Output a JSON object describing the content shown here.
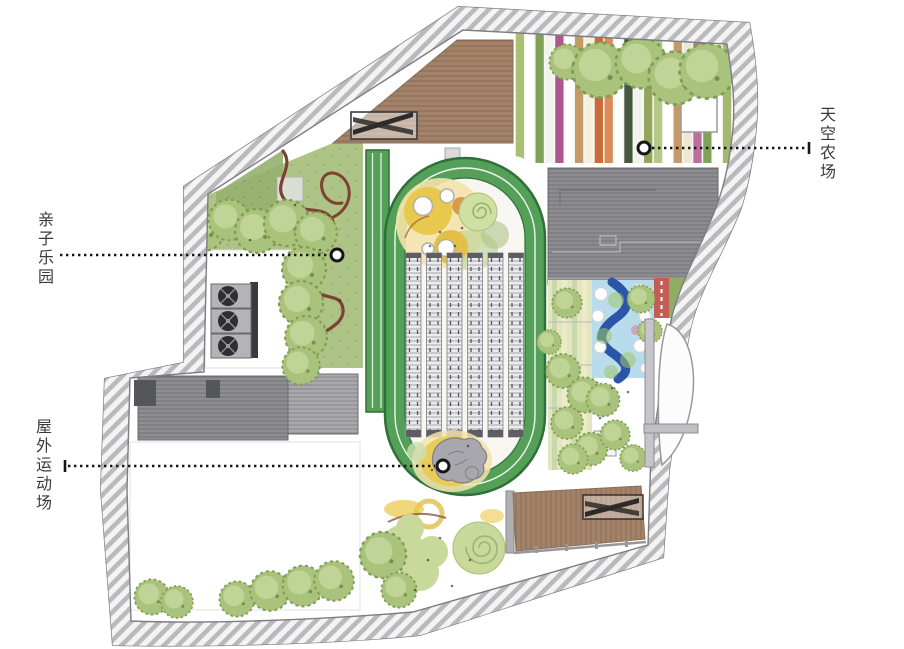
{
  "labels": {
    "family_park": "亲子乐园",
    "sky_farm": "天空农场",
    "outdoor_field": "屋外运动场"
  },
  "palette": {
    "band_hatch": "#b9b9be",
    "band_bg": "#f4f4f4",
    "band_line": "#7d7d82",
    "track_green": "#55a058",
    "track_dark": "#2f6f38",
    "lawn": "#aec487",
    "lawn_dark": "#96b070",
    "pool_blue": "#b9dcec",
    "river_blue": "#2b55a8",
    "red_lane": "#c25c56",
    "stripe_green": "#8fae62",
    "sand": "#e9c94d",
    "sand_pale": "#f3e3ab",
    "blob_green": "#c9d99c",
    "rock": "#a7a7ad",
    "path_red": "#7e4134",
    "deck_wood": "#a3826a",
    "roof_dark": "#8d8d91",
    "roof_mid": "#a9a9ad",
    "hvac_box": "#b4b4b8",
    "hvac_fan": "#2e2e32",
    "tree_fill": "#a9c37c",
    "tree_edge": "#7f9c52",
    "tree_inner": "#c6d89e",
    "ink": "#161616",
    "label_color": "#3a3a3a"
  },
  "farm": {
    "stripes": [
      "#aabf72",
      "#ffffff",
      "#7fa356",
      "#f2f2ee",
      "#b0568f",
      "#ffffff",
      "#c49a66",
      "#f5efe2",
      "#c96a3a",
      "#d88d58",
      "#ffffff",
      "#45573d",
      "#f2f2ee",
      "#93a55c",
      "#b3c986",
      "#ffffff",
      "#c49a66",
      "#f0e6d4",
      "#bc6f9e",
      "#7fa356",
      "#ffffff",
      "#a3ba6e"
    ]
  },
  "skylights": {
    "count": 6
  }
}
